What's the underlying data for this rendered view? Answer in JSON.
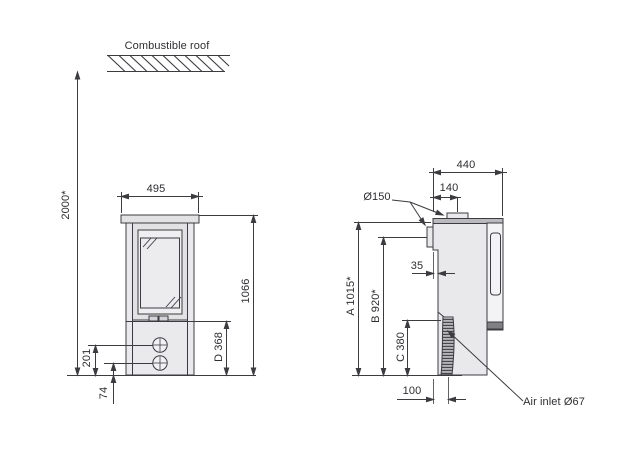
{
  "drawing": {
    "roof": {
      "label": "Combustible roof",
      "clearance": "2000*"
    },
    "front_view": {
      "width": "495",
      "height": "1066",
      "dim_d": "D 368",
      "upper_control_height": "201",
      "lower_control_height": "74"
    },
    "side_view": {
      "depth": "440",
      "flue_offset": "140",
      "flue_diameter": "Ø150",
      "rear_step": "35",
      "dim_a": "A 1015*",
      "dim_b": "B 920*",
      "dim_c": "C 380",
      "inlet_offset": "100",
      "air_inlet": "Air inlet Ø67"
    },
    "colors": {
      "line": "#3c3c40",
      "body_fill": "#e9e9eb",
      "text": "#2e2e32"
    }
  }
}
